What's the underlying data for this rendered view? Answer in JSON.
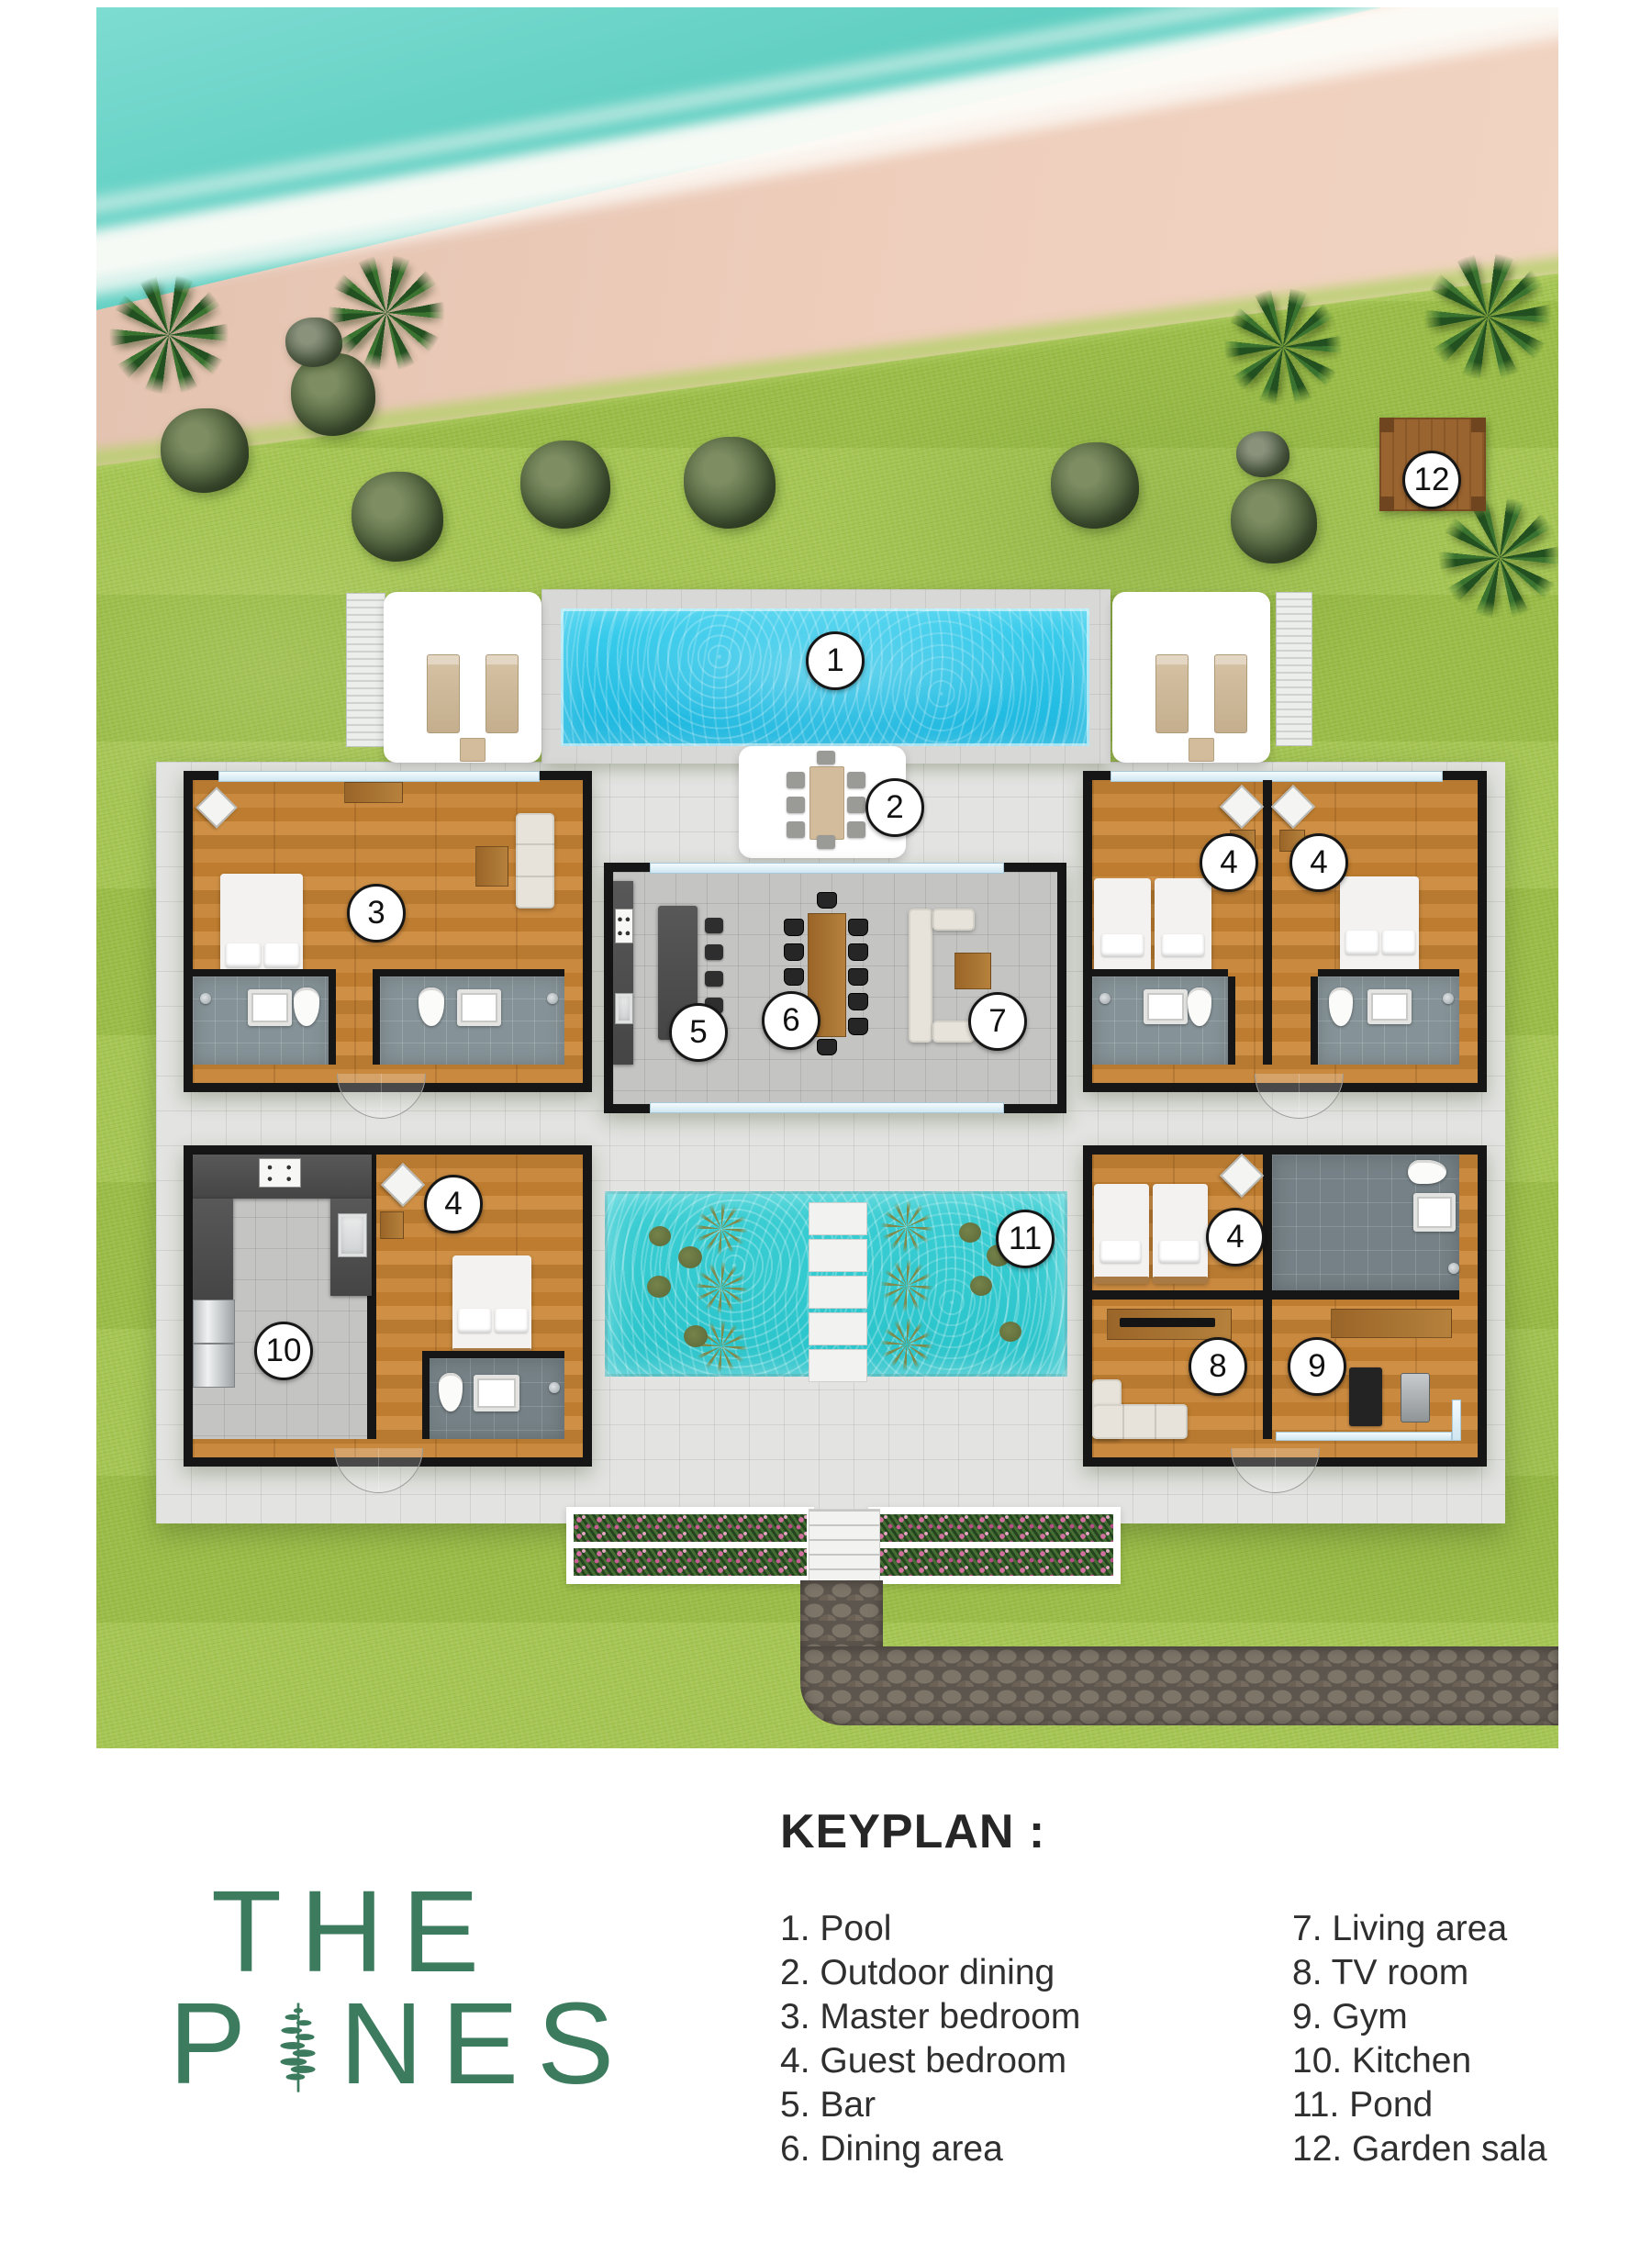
{
  "logo": {
    "line1": "THE",
    "line2_left": "P",
    "line2_right": "NES",
    "tree_icon": "pine-tree-icon",
    "color": "#3d7b5e"
  },
  "keyplan": {
    "heading": "KEYPLAN :",
    "columns": [
      [
        "1. Pool",
        "2. Outdoor dining",
        "3. Master bedroom",
        "4. Guest bedroom",
        "5. Bar",
        "6. Dining area"
      ],
      [
        "7. Living area",
        "8. TV room",
        "9. Gym",
        "10. Kitchen",
        "11. Pond",
        "12. Garden sala"
      ]
    ]
  },
  "markers": [
    {
      "number": "1",
      "label": "Pool"
    },
    {
      "number": "2",
      "label": "Outdoor dining"
    },
    {
      "number": "3",
      "label": "Master bedroom"
    },
    {
      "number": "4",
      "label": "Guest bedroom"
    },
    {
      "number": "4",
      "label": "Guest bedroom"
    },
    {
      "number": "4",
      "label": "Guest bedroom"
    },
    {
      "number": "4",
      "label": "Guest bedroom"
    },
    {
      "number": "5",
      "label": "Bar"
    },
    {
      "number": "6",
      "label": "Dining area"
    },
    {
      "number": "7",
      "label": "Living area"
    },
    {
      "number": "8",
      "label": "TV room"
    },
    {
      "number": "9",
      "label": "Gym"
    },
    {
      "number": "10",
      "label": "Kitchen"
    },
    {
      "number": "11",
      "label": "Pond"
    },
    {
      "number": "12",
      "label": "Garden sala"
    }
  ],
  "colors": {
    "logo_green": "#3d7b5e",
    "pool_water": "#2bc2e4",
    "pond_water": "#32cbd1",
    "sea_water": "#6fd4c7",
    "sand": "#eecdbb",
    "grass": "#a3c44d",
    "marker_border": "#161616"
  }
}
